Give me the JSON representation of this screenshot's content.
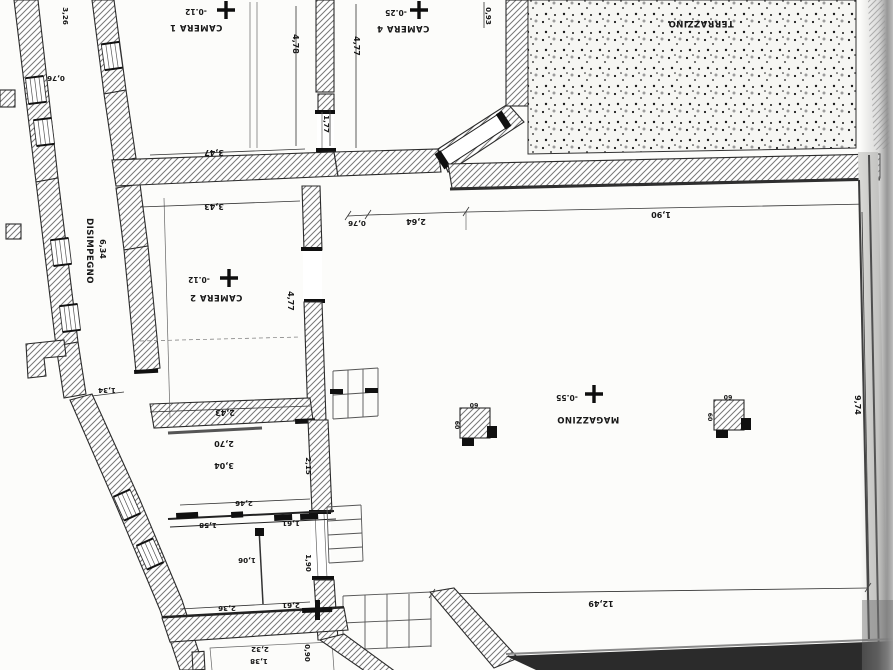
{
  "document": {
    "kind": "Scanned architectural floor plan (printed rotated 180 degrees)",
    "language": "Italian"
  },
  "colors": {
    "paper": "#fcfcfa",
    "ink": "#171717",
    "wall_hatch": "#6e6e6e",
    "scan_shadow": "#8f8f8f",
    "dark_wall_band": "#2b2b2b"
  },
  "plan": {
    "labels": [
      {
        "text": "CAMERA 1",
        "x": 196,
        "y": 25,
        "rot": 180,
        "kind": "room",
        "name": "room-label-camera-1"
      },
      {
        "text": "-0.12",
        "x": 196,
        "y": 9,
        "rot": 180,
        "kind": "level",
        "name": "level-label-camera-1"
      },
      {
        "text": "CAMERA 4",
        "x": 403,
        "y": 26,
        "rot": 180,
        "kind": "room",
        "name": "room-label-camera-4"
      },
      {
        "text": "-0.25",
        "x": 396,
        "y": 10,
        "rot": 180,
        "kind": "level",
        "name": "level-label-camera-4"
      },
      {
        "text": "TERRAZZINO",
        "x": 701,
        "y": 21,
        "rot": 180,
        "kind": "room",
        "name": "room-label-terrazzino"
      },
      {
        "text": "CAMERA 2",
        "x": 216,
        "y": 295,
        "rot": 180,
        "kind": "room",
        "name": "room-label-camera-2"
      },
      {
        "text": "-0.12",
        "x": 199,
        "y": 277,
        "rot": 180,
        "kind": "level",
        "name": "level-label-camera-2"
      },
      {
        "text": "MAGAZZINO",
        "x": 588,
        "y": 417,
        "rot": 180,
        "kind": "room",
        "name": "room-label-magazzino"
      },
      {
        "text": "-0.55",
        "x": 567,
        "y": 395,
        "rot": 180,
        "kind": "level",
        "name": "level-label-magazzino"
      },
      {
        "text": "DISIMPEGNO",
        "x": 87,
        "y": 251,
        "rot": 90,
        "kind": "room",
        "name": "room-label-disimpegno"
      },
      {
        "text": "6,34",
        "x": 100,
        "y": 249,
        "rot": 90,
        "kind": "dim",
        "name": "dim-disimpegno-length"
      },
      {
        "text": "3,26",
        "x": 63,
        "y": 16,
        "rot": 90,
        "kind": "dimsm",
        "name": "dim-top-left"
      },
      {
        "text": "0,76",
        "x": 56,
        "y": 76,
        "rot": 180,
        "kind": "dimsm",
        "name": "dim-left-window"
      },
      {
        "text": "4,78",
        "x": 293,
        "y": 44,
        "rot": 90,
        "kind": "dim",
        "name": "dim-camera1-depth"
      },
      {
        "text": "4,77",
        "x": 354,
        "y": 46,
        "rot": 90,
        "kind": "dim",
        "name": "dim-camera4-depth"
      },
      {
        "text": "0,93",
        "x": 486,
        "y": 16,
        "rot": 90,
        "kind": "dimsm",
        "name": "dim-camera4-right"
      },
      {
        "text": "1,77",
        "x": 324,
        "y": 124,
        "rot": 90,
        "kind": "dimsm",
        "name": "dim-camera4-door"
      },
      {
        "text": "3,47",
        "x": 214,
        "y": 150,
        "rot": 180,
        "kind": "dim",
        "name": "dim-camera1-width"
      },
      {
        "text": "3,43",
        "x": 214,
        "y": 204,
        "rot": 180,
        "kind": "dim",
        "name": "dim-camera2-width"
      },
      {
        "text": "4,77",
        "x": 288,
        "y": 301,
        "rot": 90,
        "kind": "dim",
        "name": "dim-camera2-depth"
      },
      {
        "text": "0,76",
        "x": 357,
        "y": 221,
        "rot": 180,
        "kind": "dimsm",
        "name": "dim-magazzino-top-1"
      },
      {
        "text": "2,64",
        "x": 416,
        "y": 219,
        "rot": 180,
        "kind": "dim",
        "name": "dim-magazzino-top-2"
      },
      {
        "text": "1,90",
        "x": 661,
        "y": 212,
        "rot": 180,
        "kind": "dim",
        "name": "dim-magazzino-top-3"
      },
      {
        "text": "1,34",
        "x": 107,
        "y": 388,
        "rot": 180,
        "kind": "dimsm",
        "name": "dim-corridor-end"
      },
      {
        "text": "2,43",
        "x": 225,
        "y": 410,
        "rot": 180,
        "kind": "dim",
        "name": "dim-camera2-bottom"
      },
      {
        "text": "2,70",
        "x": 224,
        "y": 441,
        "rot": 180,
        "kind": "dim",
        "name": "dim-room-a-1"
      },
      {
        "text": "3,04",
        "x": 224,
        "y": 463,
        "rot": 180,
        "kind": "dim",
        "name": "dim-room-a-2"
      },
      {
        "text": "2,15",
        "x": 306,
        "y": 466,
        "rot": 90,
        "kind": "dimsm",
        "name": "dim-room-a-height"
      },
      {
        "text": "2,46",
        "x": 244,
        "y": 501,
        "rot": 180,
        "kind": "dimsm",
        "name": "dim-room-a-bottom"
      },
      {
        "text": "1,58",
        "x": 208,
        "y": 523,
        "rot": 180,
        "kind": "dimsm",
        "name": "dim-room-b-top"
      },
      {
        "text": "1,61",
        "x": 291,
        "y": 521,
        "rot": 180,
        "kind": "dimsm",
        "name": "dim-room-c-top"
      },
      {
        "text": "1,06",
        "x": 247,
        "y": 558,
        "rot": 180,
        "kind": "dimsm",
        "name": "dim-room-b-inner"
      },
      {
        "text": "1,90",
        "x": 306,
        "y": 563,
        "rot": 90,
        "kind": "dimsm",
        "name": "dim-room-c-side"
      },
      {
        "text": "2,36",
        "x": 227,
        "y": 606,
        "rot": 180,
        "kind": "dimsm",
        "name": "dim-room-b-bottom"
      },
      {
        "text": "2,61",
        "x": 291,
        "y": 603,
        "rot": 180,
        "kind": "dimsm",
        "name": "dim-room-c-bottom"
      },
      {
        "text": "2,32",
        "x": 260,
        "y": 647,
        "rot": 180,
        "kind": "dimsm",
        "name": "dim-room-d-1"
      },
      {
        "text": "1,38",
        "x": 259,
        "y": 659,
        "rot": 180,
        "kind": "dimsm",
        "name": "dim-room-d-2"
      },
      {
        "text": "0,90",
        "x": 305,
        "y": 653,
        "rot": 90,
        "kind": "dimsm",
        "name": "dim-room-d-side"
      },
      {
        "text": "9,74",
        "x": 855,
        "y": 405,
        "rot": 90,
        "kind": "dim",
        "name": "dim-magazzino-depth"
      },
      {
        "text": "12,49",
        "x": 601,
        "y": 601,
        "rot": 180,
        "kind": "dim",
        "name": "dim-magazzino-width"
      },
      {
        "text": "60",
        "x": 474,
        "y": 403,
        "rot": 180,
        "kind": "tiny",
        "name": "dim-pillar1-a"
      },
      {
        "text": "60",
        "x": 455,
        "y": 425,
        "rot": 90,
        "kind": "tiny",
        "name": "dim-pillar1-b"
      },
      {
        "text": "60",
        "x": 728,
        "y": 395,
        "rot": 180,
        "kind": "tiny",
        "name": "dim-pillar2-a"
      },
      {
        "text": "60",
        "x": 708,
        "y": 417,
        "rot": 90,
        "kind": "tiny",
        "name": "dim-pillar2-b"
      }
    ],
    "level_markers": [
      {
        "x": 226,
        "y": 10,
        "name": "level-marker-camera-1"
      },
      {
        "x": 419,
        "y": 10,
        "name": "level-marker-camera-4"
      },
      {
        "x": 229,
        "y": 278,
        "name": "level-marker-camera-2"
      },
      {
        "x": 594,
        "y": 394,
        "name": "level-marker-magazzino"
      }
    ]
  }
}
